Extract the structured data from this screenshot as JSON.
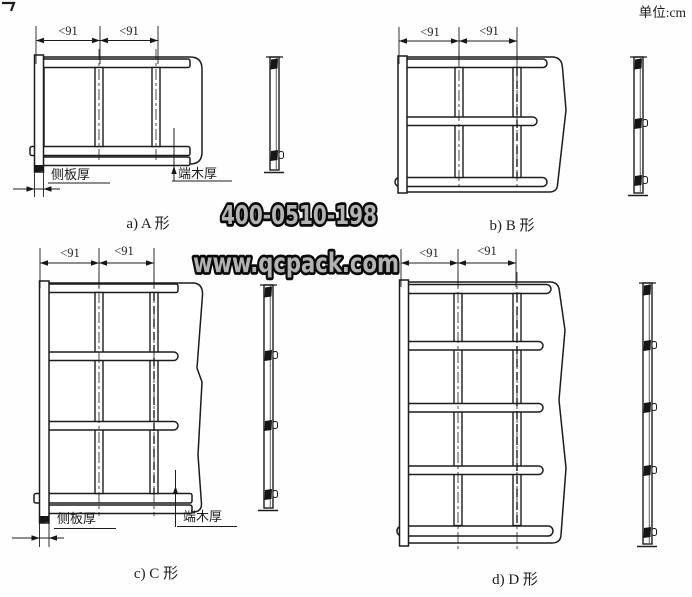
{
  "unit_note": "单位:cm",
  "watermarks": {
    "phone": "400-0510-198",
    "site": "www.qcpack.com"
  },
  "diagrams": {
    "a": {
      "caption": "a) A 形",
      "dims": [
        "<91",
        "<91"
      ],
      "side_board_label": "侧板厚",
      "end_wood_label": "端木厚",
      "panels": {
        "rows": 1,
        "cols": 2
      }
    },
    "b": {
      "caption": "b) B 形",
      "dims": [
        "<91",
        "<91"
      ],
      "panels": {
        "rows": 2,
        "cols": 2
      }
    },
    "c": {
      "caption": "c) C 形",
      "dims": [
        "<91",
        "<91"
      ],
      "side_board_label": "侧板厚",
      "end_wood_label": "端木厚",
      "panels": {
        "rows": 3,
        "cols": 2
      }
    },
    "d": {
      "caption": "d) D 形",
      "dims": [
        "<91",
        "<91"
      ],
      "panels": {
        "rows": 4,
        "cols": 2
      }
    }
  },
  "colors": {
    "line": "#1c1c1c",
    "paper": "#fefefe",
    "watermark_fill": "#b3b3b3",
    "watermark_outline": "#0a0a0a"
  }
}
